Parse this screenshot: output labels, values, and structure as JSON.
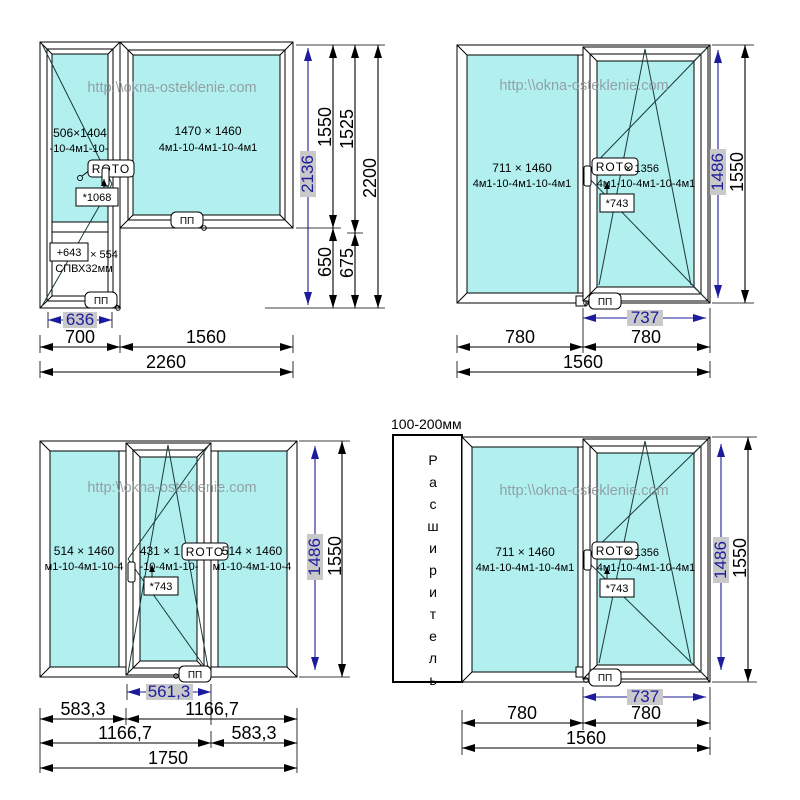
{
  "labels": {
    "watermark": "http:\\\\okna-osteklenie.com",
    "roto": "ROTO",
    "pp": "ПП"
  },
  "w1": {
    "door_size": "506×1404",
    "door_formula": "-10-4м1-10-",
    "win_size": "1470 × 1460",
    "win_formula": "4м1-10-4м1-10-4м1",
    "handle_note": "*1068",
    "panel_note": "+643",
    "panel_note2": "× 554",
    "panel_type": "СПВХ32мм",
    "dim_sash_w": "636",
    "dim_door_w": "700",
    "dim_win_w": "1560",
    "dim_total_w": "2260",
    "dim_door_h": "2136",
    "dim_h1550": "1550",
    "dim_h650": "650",
    "dim_h1525": "1525",
    "dim_h675": "675",
    "dim_total_h": "2200"
  },
  "w2": {
    "fixed_size": "711 × 1460",
    "fixed_formula": "4м1-10-4м1-10-4м1",
    "sash_size": "× 1356",
    "sash_formula": "4м1-10-4м1-10-4м1",
    "handle_note": "*743",
    "dim_sash_w": "737",
    "dim_left_w": "780",
    "dim_right_w": "780",
    "dim_total_w": "1560",
    "dim_sash_h": "1486",
    "dim_total_h": "1550"
  },
  "w3": {
    "left_size": "514 × 1460",
    "left_formula": "м1-10-4м1-10-4",
    "mid_size": "431 × 1",
    "mid_formula": "-10-4м1-10-",
    "right_size": "514 × 1460",
    "right_formula": "м1-10-4м1-10-4",
    "handle_note": "*743",
    "dim_sash_w": "561,3",
    "dim_r1a": "583,3",
    "dim_r1b": "1166,7",
    "dim_r2a": "1166,7",
    "dim_r2b": "583,3",
    "dim_total_w": "1750",
    "dim_sash_h": "1486",
    "dim_total_h": "1550"
  },
  "w4": {
    "note": "100-200мм",
    "expander": "Расширитель",
    "fixed_size": "711 × 1460",
    "fixed_formula": "4м1-10-4м1-10-4м1",
    "sash_size": "× 1356",
    "sash_formula": "4м1-10-4м1-10-4м1",
    "handle_note": "*743",
    "dim_sash_w": "737",
    "dim_left_w": "780",
    "dim_right_w": "780",
    "dim_total_w": "1560",
    "dim_sash_h": "1486",
    "dim_total_h": "1550"
  }
}
